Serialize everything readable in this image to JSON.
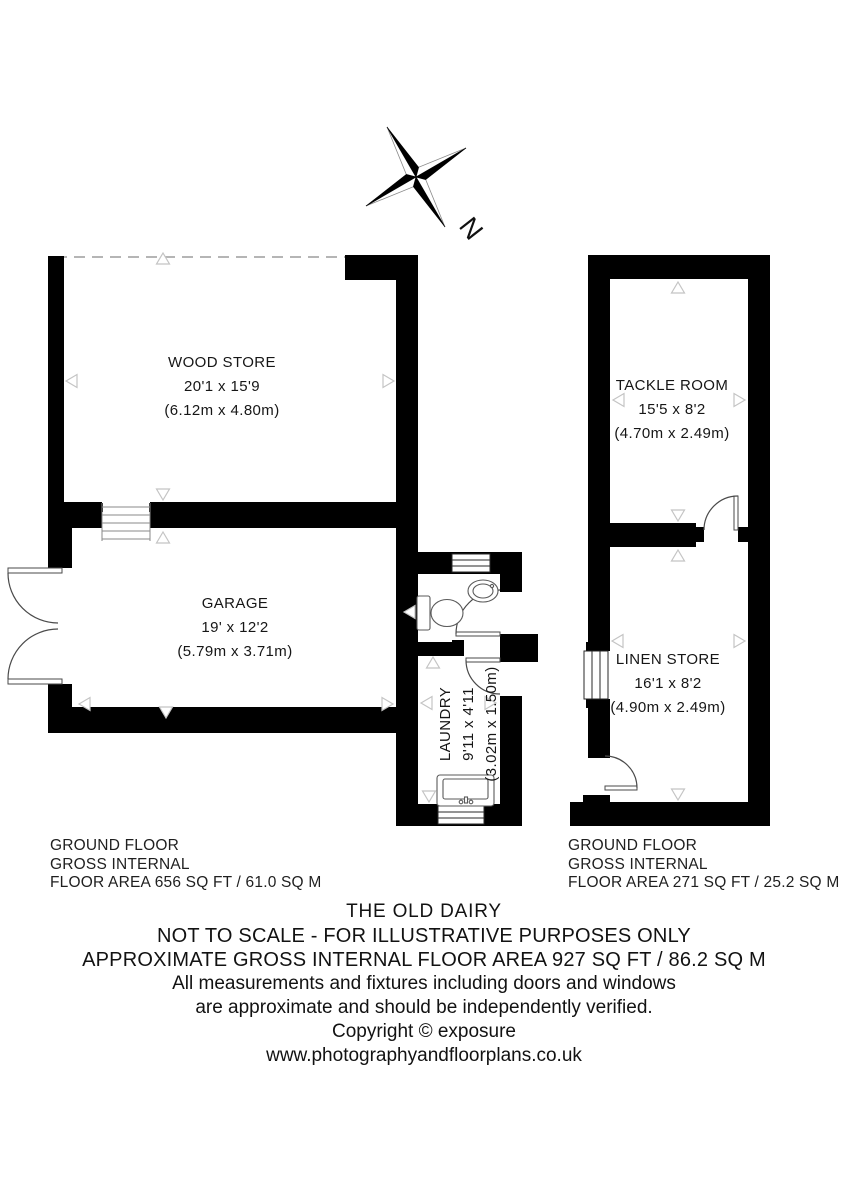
{
  "compass": {
    "north": "N"
  },
  "rooms": {
    "wood_store": {
      "name": "WOOD STORE",
      "dims": "20'1 x 15'9",
      "metric": "(6.12m x 4.80m)"
    },
    "garage": {
      "name": "GARAGE",
      "dims": "19' x 12'2",
      "metric": "(5.79m x 3.71m)"
    },
    "laundry": {
      "name": "LAUNDRY",
      "dims": "9'11 x 4'11",
      "metric": "(3.02m x 1.50m)"
    },
    "tackle_room": {
      "name": "TACKLE ROOM",
      "dims": "15'5 x 8'2",
      "metric": "(4.70m x 2.49m)"
    },
    "linen_store": {
      "name": "LINEN STORE",
      "dims": "16'1 x 8'2",
      "metric": "(4.90m x 2.49m)"
    }
  },
  "areas": {
    "left": {
      "floor": "GROUND FLOOR",
      "internal": "GROSS INTERNAL",
      "area": "FLOOR AREA 656 SQ FT / 61.0 SQ M"
    },
    "right": {
      "floor": "GROUND FLOOR",
      "internal": "GROSS INTERNAL",
      "area": "FLOOR AREA 271 SQ FT / 25.2 SQ M"
    }
  },
  "footer": {
    "title": "THE OLD DAIRY",
    "not_to_scale": "NOT TO SCALE - FOR ILLUSTRATIVE PURPOSES ONLY",
    "approx_area": "APPROXIMATE GROSS INTERNAL FLOOR AREA 927 SQ FT / 86.2 SQ M",
    "disclaimer1": "All measurements and fixtures including doors and windows",
    "disclaimer2": "are approximate and should be independently verified.",
    "copyright": "Copyright © exposure",
    "website": "www.photographyandfloorplans.co.uk"
  },
  "colors": {
    "wall": "#000000",
    "marker": "#c4c4c4",
    "text": "#1a1a1a"
  }
}
